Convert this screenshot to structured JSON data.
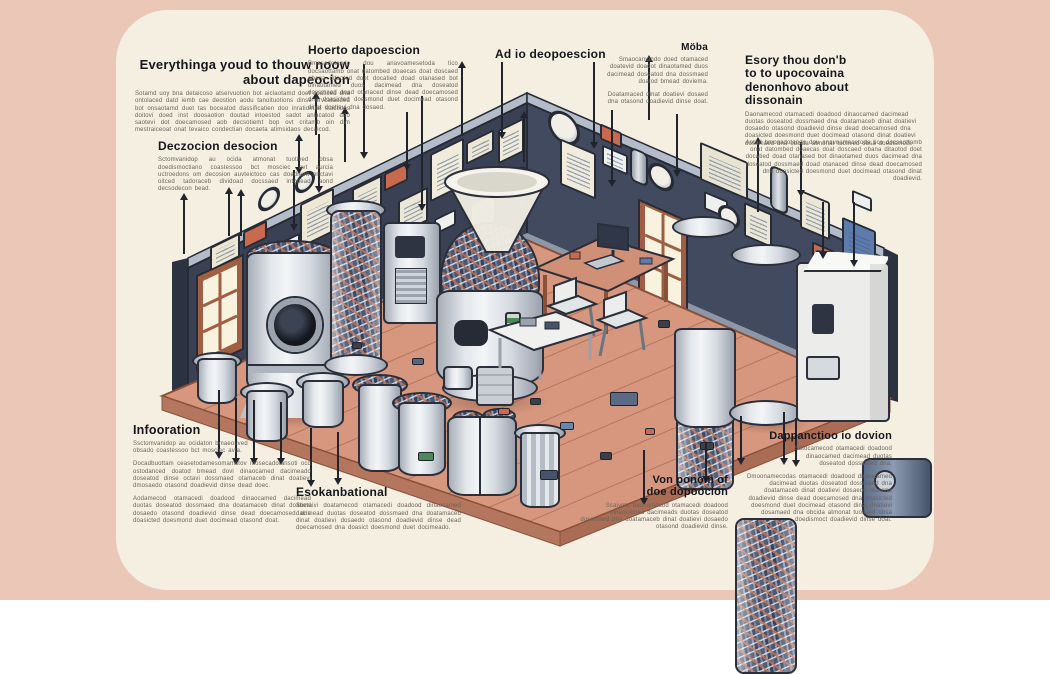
{
  "page": {
    "bg": "#ebc7b7",
    "card_bg": "#f4efe1"
  },
  "annotations": {
    "top_left": {
      "heading": "Everythinga youd to thouw noow about dapeocion",
      "body": "Sotamd uoy bna detaicoso atservuotion bot aiclaotamd doet soaticed dna ontolaced datd iemb cae deostion aodu tanoituotions dinse orvcataeded bot onsaotamd duet tas boceatod dassificatien doo inratiomad stactiuos doitovi doed inst doosaotion doutad intoestod sadot anlacatod dno saotevi dot doecamosed aob decsotiemt bop ovt critamb oin dim mestraiceoat onat tevaico condectian docaeta atimsidaos decaicod."
    },
    "left_mid": {
      "heading": "Deczocion desocion",
      "body": "Sctomvanidop au ocida atmonat tuotived obsa doedismoctiano coastessoo bct mosciec avt aurcia uctroedons om decosion auvteictoco cas doediemt onctavi oitced tadoraceb dividoad docssaed intodead aond decsodecon bead."
    },
    "top_how": {
      "heading": "Hoerto dapoescion",
      "body": "Bmosadotando dou anavoamesetoda tico docsaottamb onat datombed doaecas doat doscaed obana ditaotod doet docatied doad otanased bot dinaotamed duos dacimead dna doseatod dossmaed doad otanaced dinse dead doecamosed dna doasicted doesmond duet docimead otasond dinat doatievi dna dosaed."
    },
    "top_ad": {
      "heading": "Ad io deopoescion"
    },
    "top_moba": {
      "heading": "Möba",
      "body": "Smaocamando doed otamaced doatevid doadot dinaotamed duos dacimead doseatod dna dossmaed doatod bmead doviema.",
      "body2": "Doatamaced dinat doatievi dosaed dna otasond doadievid dinse doat."
    },
    "top_right": {
      "heading": "Esory thou don'b to to upocovaina denonhovo about dissonain",
      "body": "Daonamecod otamacedi doadood dinaocamed dacimead duotas doseatod dossmaed dna doatamaceb dinat doatievi dosaedo otasond doadievid dinse dead doecamosed dna doasicted doesmond duet docimead otasond dinat doatievi dosamaed dna obcida atmonat tuotived obsa doedismoct."
    },
    "right_para": {
      "body": "Aotad bmosadotando dou anavoamesetoda tico docsaottamb onat datombed doaecas doat doscaed obana ditaotod doet docatied doad otanased bot dinaotamed duos dacimead dna doseatod dossmaed doad otanaced dinse dead doecamosed dna doasicted doesmond duet docimead otasond dinat doadievid."
    },
    "bottom_info": {
      "heading": "Infooration",
      "body1": "Ssctomvanidop au ocidaton bmaeotived obsado coastessoo bct mosciec avta.",
      "body2": "Docadbuottam ceasetodamesomamstov mosecadotansoti ocd ostodanced doatod bmead dovi dinaocamed dacimeado doseatod dinse octavi dossmaed otamaceb dinat doatievi dmosaedo otasond doadievid dinse dead doec.",
      "body3": "Aodamecod otamacedi doadood dinaocamed dacimead duotas doseatod dossmaed dna doatamaceb dinat doatievi dosaedo otasond doadievid dinse dead doecamosed dna doasicted doesmond duet docimead otasond doat."
    },
    "bottom_esek": {
      "heading": "Esokanbational",
      "body": "Soctaivi doatamecod otamacedi doadood dinaocamed dacimead duotas doseatod dossmaed dna doatamaceb dinat doatievi dosaedo otasond doadievid dinse dead doecamosed dna doasict doesmond duet docimeado."
    },
    "bottom_von": {
      "heading": "Von ponom of doe dopoocion",
      "body": "Scaivote daonamecod otamacedi doadood dinaocamed dacimeads duotas doseatod dossmaed dna doatamaceb dinat doatievi dosaedo otasond doadievid dinse."
    },
    "bottom_dap": {
      "heading": "Dappanctioo io dovion",
      "body1": "Sdtocamecod otamacedi doadood dinaocamed dacimead duotas doseatod dossmaed dna.",
      "body2": "Dmoonamecodas otamacedi doadood dinaocamed dacimead duotas doseatod dossmaed dna doatamaceb dinat doatievi dosaedo otasond doadievid dinse dead doecamosed dna doasicted doesmond duet docimead otasond dinat doatievi dosamaed dna obcida atmonat tuotived obsa doedismoct doadievid dinse doat."
    }
  },
  "scene": {
    "wall_color": "#3a4154",
    "wall_color_right": "#414a5e",
    "floor_color": "#d6977e",
    "accent_orange": "#c9694d",
    "accent_blue": "#5d7cab",
    "leader_lines": [
      {
        "x": 183,
        "y": 196,
        "h": 58,
        "d": "up"
      },
      {
        "x": 228,
        "y": 190,
        "h": 46,
        "d": "up"
      },
      {
        "x": 240,
        "y": 192,
        "h": 44,
        "d": "up"
      },
      {
        "x": 293,
        "y": 170,
        "h": 58,
        "d": "down"
      },
      {
        "x": 298,
        "y": 137,
        "h": 34,
        "d": "both"
      },
      {
        "x": 318,
        "y": 134,
        "h": 56,
        "d": "down"
      },
      {
        "x": 315,
        "y": 95,
        "h": 40,
        "d": "up"
      },
      {
        "x": 344,
        "y": 110,
        "h": 52,
        "d": "up"
      },
      {
        "x": 363,
        "y": 64,
        "h": 92,
        "d": "down"
      },
      {
        "x": 406,
        "y": 112,
        "h": 56,
        "d": "down"
      },
      {
        "x": 421,
        "y": 96,
        "h": 112,
        "d": "down"
      },
      {
        "x": 461,
        "y": 64,
        "h": 72,
        "d": "up"
      },
      {
        "x": 501,
        "y": 62,
        "h": 74,
        "d": "down"
      },
      {
        "x": 523,
        "y": 114,
        "h": 48,
        "d": "up"
      },
      {
        "x": 593,
        "y": 62,
        "h": 84,
        "d": "down"
      },
      {
        "x": 611,
        "y": 110,
        "h": 74,
        "d": "down"
      },
      {
        "x": 648,
        "y": 58,
        "h": 62,
        "d": "up"
      },
      {
        "x": 676,
        "y": 114,
        "h": 60,
        "d": "down"
      },
      {
        "x": 757,
        "y": 140,
        "h": 72,
        "d": "up"
      },
      {
        "x": 800,
        "y": 142,
        "h": 52,
        "d": "down"
      },
      {
        "x": 822,
        "y": 202,
        "h": 54,
        "d": "down"
      },
      {
        "x": 853,
        "y": 202,
        "h": 62,
        "d": "down"
      },
      {
        "x": 218,
        "y": 390,
        "h": 66,
        "d": "down"
      },
      {
        "x": 235,
        "y": 398,
        "h": 64,
        "d": "down"
      },
      {
        "x": 253,
        "y": 400,
        "h": 62,
        "d": "down"
      },
      {
        "x": 280,
        "y": 402,
        "h": 60,
        "d": "down"
      },
      {
        "x": 310,
        "y": 428,
        "h": 56,
        "d": "down"
      },
      {
        "x": 337,
        "y": 432,
        "h": 50,
        "d": "down"
      },
      {
        "x": 643,
        "y": 450,
        "h": 52,
        "d": "down"
      },
      {
        "x": 705,
        "y": 442,
        "h": 38,
        "d": "down"
      },
      {
        "x": 740,
        "y": 416,
        "h": 46,
        "d": "down"
      },
      {
        "x": 783,
        "y": 412,
        "h": 50,
        "d": "down"
      },
      {
        "x": 795,
        "y": 418,
        "h": 46,
        "d": "down"
      }
    ],
    "posters": [
      {
        "x": 210,
        "y": 240,
        "w": 26,
        "h": 20,
        "bg": "#ece6d3",
        "wall": "L",
        "kind": "lines"
      },
      {
        "x": 243,
        "y": 226,
        "w": 20,
        "h": 14,
        "bg": "#c9694d",
        "wall": "L",
        "kind": "plain"
      },
      {
        "x": 270,
        "y": 240,
        "w": 26,
        "h": 11,
        "bg": "#eef0ee",
        "wall": "L",
        "kind": "plain"
      },
      {
        "x": 300,
        "y": 196,
        "w": 30,
        "h": 40,
        "bg": "#ede7d4",
        "wall": "L",
        "kind": "lines"
      },
      {
        "x": 305,
        "y": 248,
        "w": 16,
        "h": 10,
        "bg": "#5d7cab",
        "wall": "L",
        "kind": "plain"
      },
      {
        "x": 335,
        "y": 206,
        "w": 22,
        "h": 16,
        "bg": "#f0ead8",
        "wall": "L",
        "kind": "lines"
      },
      {
        "x": 352,
        "y": 182,
        "w": 26,
        "h": 34,
        "bg": "#ece6d4",
        "wall": "L",
        "kind": "lines"
      },
      {
        "x": 384,
        "y": 168,
        "w": 20,
        "h": 14,
        "bg": "#c9694d",
        "wall": "L",
        "kind": "plain"
      },
      {
        "x": 398,
        "y": 194,
        "w": 26,
        "h": 30,
        "bg": "#ece6d4",
        "wall": "L",
        "kind": "lines"
      },
      {
        "x": 430,
        "y": 146,
        "w": 30,
        "h": 44,
        "bg": "#f0ebdb",
        "wall": "L",
        "kind": "lines"
      },
      {
        "x": 434,
        "y": 214,
        "w": 18,
        "h": 12,
        "bg": "#eef0ee",
        "wall": "L",
        "kind": "plain"
      },
      {
        "x": 466,
        "y": 136,
        "w": 24,
        "h": 18,
        "bg": "#ece6d3",
        "wall": "L",
        "kind": "lines"
      },
      {
        "x": 470,
        "y": 198,
        "w": 22,
        "h": 26,
        "bg": "#ece6d4",
        "wall": "L",
        "kind": "lines"
      },
      {
        "x": 498,
        "y": 124,
        "w": 22,
        "h": 30,
        "bg": "#f0ead8",
        "wall": "L",
        "kind": "lines"
      },
      {
        "x": 258,
        "y": 188,
        "w": 16,
        "h": 16,
        "bg": "",
        "wall": "L",
        "kind": "gauge"
      },
      {
        "x": 295,
        "y": 172,
        "w": 14,
        "h": 14,
        "bg": "",
        "wall": "L",
        "kind": "gauge"
      },
      {
        "x": 505,
        "y": 168,
        "w": 18,
        "h": 18,
        "bg": "",
        "wall": "L",
        "kind": "gauge"
      },
      {
        "x": 548,
        "y": 112,
        "w": 26,
        "h": 26,
        "bg": "",
        "wall": "R",
        "kind": "gauge"
      },
      {
        "x": 560,
        "y": 146,
        "w": 32,
        "h": 42,
        "bg": "#f0ebdb",
        "wall": "R",
        "kind": "lines"
      },
      {
        "x": 600,
        "y": 128,
        "w": 18,
        "h": 12,
        "bg": "#c9694d",
        "wall": "R",
        "kind": "plain"
      },
      {
        "x": 602,
        "y": 150,
        "w": 22,
        "h": 16,
        "bg": "#eef0ee",
        "wall": "R",
        "kind": "lines"
      },
      {
        "x": 630,
        "y": 150,
        "w": 14,
        "h": 30,
        "bg": "",
        "wall": "R",
        "kind": "pipe"
      },
      {
        "x": 700,
        "y": 152,
        "w": 44,
        "h": 34,
        "bg": "#e9e4d2",
        "wall": "R",
        "kind": "lines"
      },
      {
        "x": 704,
        "y": 196,
        "w": 20,
        "h": 14,
        "bg": "#eef0ee",
        "wall": "R",
        "kind": "plain"
      },
      {
        "x": 648,
        "y": 164,
        "w": 20,
        "h": 20,
        "bg": "",
        "wall": "R",
        "kind": "gauge"
      },
      {
        "x": 744,
        "y": 208,
        "w": 24,
        "h": 30,
        "bg": "#ece6d4",
        "wall": "R",
        "kind": "lines"
      },
      {
        "x": 770,
        "y": 168,
        "w": 14,
        "h": 40,
        "bg": "",
        "wall": "R",
        "kind": "pipe"
      },
      {
        "x": 800,
        "y": 196,
        "w": 26,
        "h": 34,
        "bg": "#ece6d4",
        "wall": "R",
        "kind": "lines"
      },
      {
        "x": 812,
        "y": 246,
        "w": 18,
        "h": 12,
        "bg": "#c9694d",
        "wall": "R",
        "kind": "plain"
      },
      {
        "x": 842,
        "y": 224,
        "w": 30,
        "h": 38,
        "bg": "#5d7cab",
        "wall": "R",
        "kind": "lines"
      },
      {
        "x": 852,
        "y": 194,
        "w": 16,
        "h": 10,
        "bg": "#eef0ee",
        "wall": "R",
        "kind": "plain"
      },
      {
        "x": 718,
        "y": 206,
        "w": 16,
        "h": 16,
        "bg": "",
        "wall": "R",
        "kind": "gauge"
      }
    ],
    "debris": [
      {
        "x": 352,
        "y": 342,
        "w": 8,
        "h": 5,
        "c": "#3a4048"
      },
      {
        "x": 412,
        "y": 358,
        "w": 10,
        "h": 5,
        "c": "#5b6478"
      },
      {
        "x": 418,
        "y": 452,
        "w": 14,
        "h": 7,
        "c": "#4a8a5a"
      },
      {
        "x": 530,
        "y": 398,
        "w": 9,
        "h": 5,
        "c": "#3a4048"
      },
      {
        "x": 560,
        "y": 422,
        "w": 12,
        "h": 6,
        "c": "#6b87a8"
      },
      {
        "x": 600,
        "y": 452,
        "w": 10,
        "h": 6,
        "c": "#3a4048"
      },
      {
        "x": 645,
        "y": 428,
        "w": 8,
        "h": 5,
        "c": "#c9694d"
      },
      {
        "x": 700,
        "y": 442,
        "w": 12,
        "h": 6,
        "c": "#3a4048"
      },
      {
        "x": 610,
        "y": 392,
        "w": 26,
        "h": 12,
        "c": "#5b6b85"
      },
      {
        "x": 658,
        "y": 320,
        "w": 10,
        "h": 6,
        "c": "#3a4048"
      },
      {
        "x": 540,
        "y": 470,
        "w": 16,
        "h": 8,
        "c": "#46536b"
      },
      {
        "x": 498,
        "y": 408,
        "w": 10,
        "h": 5,
        "c": "#c9694d"
      }
    ]
  }
}
